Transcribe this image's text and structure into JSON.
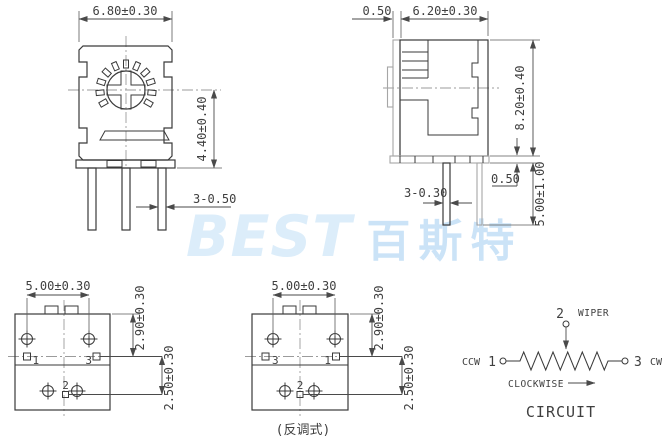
{
  "watermark": {
    "brand": "BEST",
    "brand_cjk": "百斯特"
  },
  "front_view": {
    "width_dim": "6.80±0.30",
    "height_dim": "4.40±0.40",
    "pin_dim": "3-0.50"
  },
  "side_view": {
    "lip_dim": "0.50",
    "width_dim": "6.20±0.30",
    "height_dim": "8.20±0.40",
    "base_dim": "0.50",
    "pin_length_dim": "5.00±1.00",
    "pin_dim": "3-0.30"
  },
  "bottom_view": {
    "width_dim": "5.00±0.30",
    "upper_dim": "2.90±0.30",
    "lower_dim": "2.50±0.30",
    "pin1": "1",
    "pin2": "2",
    "pin3": "3"
  },
  "bottom_view_reverse": {
    "width_dim": "5.00±0.30",
    "upper_dim": "2.90±0.30",
    "lower_dim": "2.50±0.30",
    "pin1": "1",
    "pin2": "2",
    "pin3": "3",
    "caption": "(反调式)"
  },
  "circuit": {
    "wiper_num": "2",
    "wiper_label": "WIPER",
    "ccw_label": "CCW",
    "ccw_num": "1",
    "cw_num": "3",
    "cw_label": "CW",
    "rotation_label": "CLOCKWISE",
    "title": "CIRCUIT"
  },
  "colors": {
    "line_dark": "#3a3a3a",
    "line_gray": "#a6a6a6",
    "watermark_latin": "#dcedfa",
    "watermark_cjk": "#cbe3f7"
  }
}
